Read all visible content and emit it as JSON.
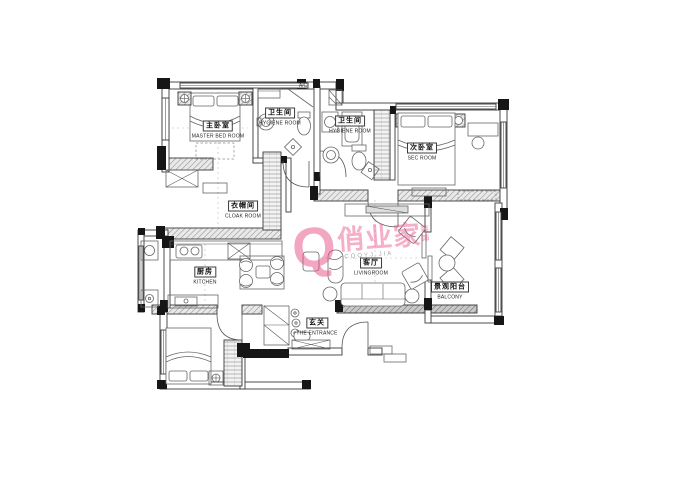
{
  "watermark": {
    "logo_letter": "Q",
    "brand": "俏业家",
    "brand_suffix": "装饰",
    "subtext": "CQQYJ.JIA",
    "color": "#e94f87"
  },
  "rooms": [
    {
      "id": "master-bedroom",
      "name_cn": "主卧室",
      "name_en": "MASTER BED ROOM"
    },
    {
      "id": "hygiene-room-1",
      "name_cn": "卫生间",
      "name_en": "HYGIENE ROOM"
    },
    {
      "id": "hygiene-room-2",
      "name_cn": "卫生间",
      "name_en": "HYGIENE ROOM"
    },
    {
      "id": "sec-room",
      "name_cn": "次卧室",
      "name_en": "SEC ROOM"
    },
    {
      "id": "cloak-room",
      "name_cn": "衣帽间",
      "name_en": "CLOAK ROOM"
    },
    {
      "id": "kitchen",
      "name_cn": "厨房",
      "name_en": "KITCHEN"
    },
    {
      "id": "living-room",
      "name_cn": "客厅",
      "name_en": "LIVINGROOM"
    },
    {
      "id": "balcony",
      "name_cn": "景观阳台",
      "name_en": "BALCONY"
    },
    {
      "id": "entrance",
      "name_cn": "玄关",
      "name_en": "THE ENTRANCE"
    }
  ],
  "annotations": {
    "ac_label": "A/C"
  }
}
